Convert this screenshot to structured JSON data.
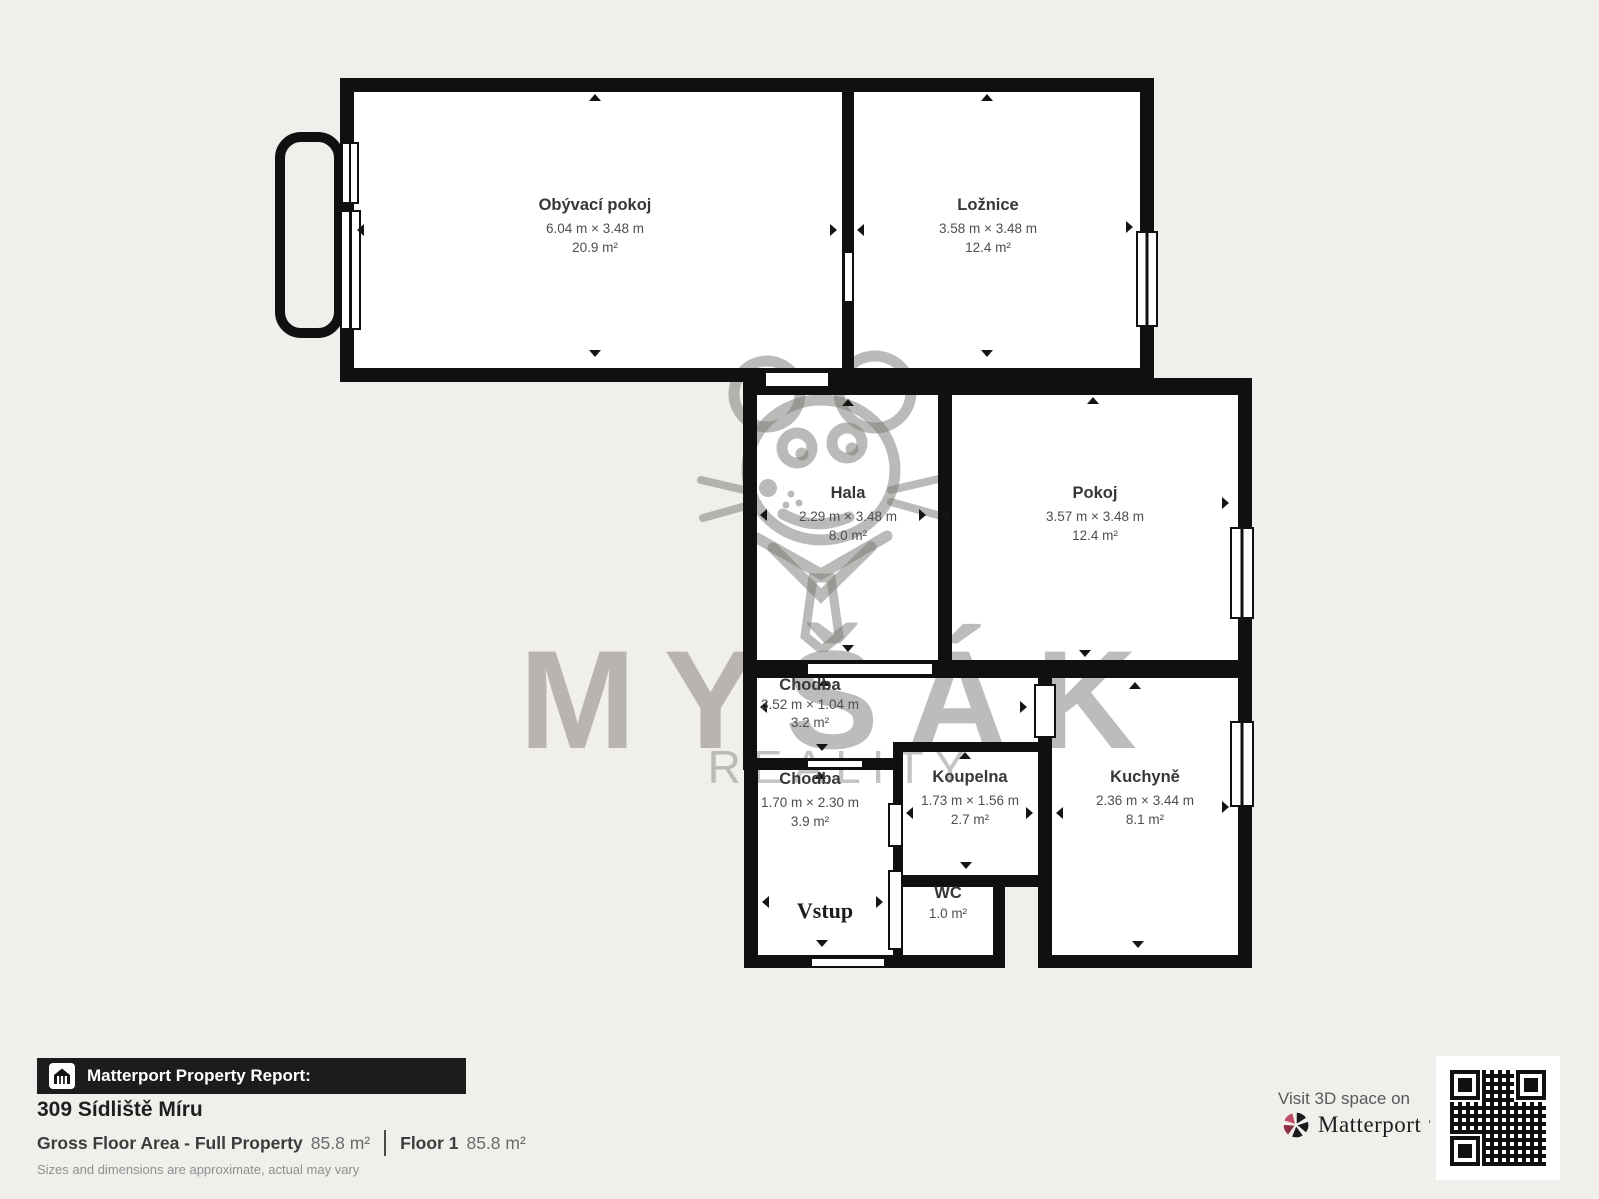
{
  "plan": {
    "rooms": [
      {
        "name": "Obývací pokoj",
        "dims": "6.04 m × 3.48 m",
        "area": "20.9 m²"
      },
      {
        "name": "Ložnice",
        "dims": "3.58 m × 3.48 m",
        "area": "12.4 m²"
      },
      {
        "name": "Hala",
        "dims": "2.29 m × 3.48 m",
        "area": "8.0 m²"
      },
      {
        "name": "Pokoj",
        "dims": "3.57 m × 3.48 m",
        "area": "12.4 m²"
      },
      {
        "name": "Chodba",
        "dims": "3.52 m × 1.04 m",
        "area": "3.2 m²"
      },
      {
        "name": "Chodba",
        "dims": "1.70 m × 2.30 m",
        "area": "3.9 m²"
      },
      {
        "name": "Koupelna",
        "dims": "1.73 m × 1.56 m",
        "area": "2.7 m²"
      },
      {
        "name": "Kuchyně",
        "dims": "2.36 m × 3.44 m",
        "area": "8.1 m²"
      },
      {
        "name": "WC",
        "area": "1.0 m²"
      }
    ],
    "entrance_label": "Vstup",
    "watermark_line1": "MYŠÁK",
    "watermark_line2": "REALITY"
  },
  "footer": {
    "report_bar_label": "Matterport Property Report:",
    "address": "309 Sídliště Míru",
    "gfa_label": "Gross Floor Area - Full Property",
    "gfa_value": "85.8 m²",
    "floor_label": "Floor 1",
    "floor_value": "85.8 m²",
    "disclaimer": "Sizes and dimensions are approximate, actual may vary"
  },
  "cta": {
    "visit_text": "Visit 3D space on",
    "brand": "Matterport",
    "brand_mark": "’"
  },
  "colors": {
    "background": "#f1efec",
    "wall": "#101010",
    "room_fill": "#ffffff",
    "watermark_gray": "#8f8c89",
    "brand_pink": "#c04b64",
    "bar_bg": "#1d1b1b"
  }
}
